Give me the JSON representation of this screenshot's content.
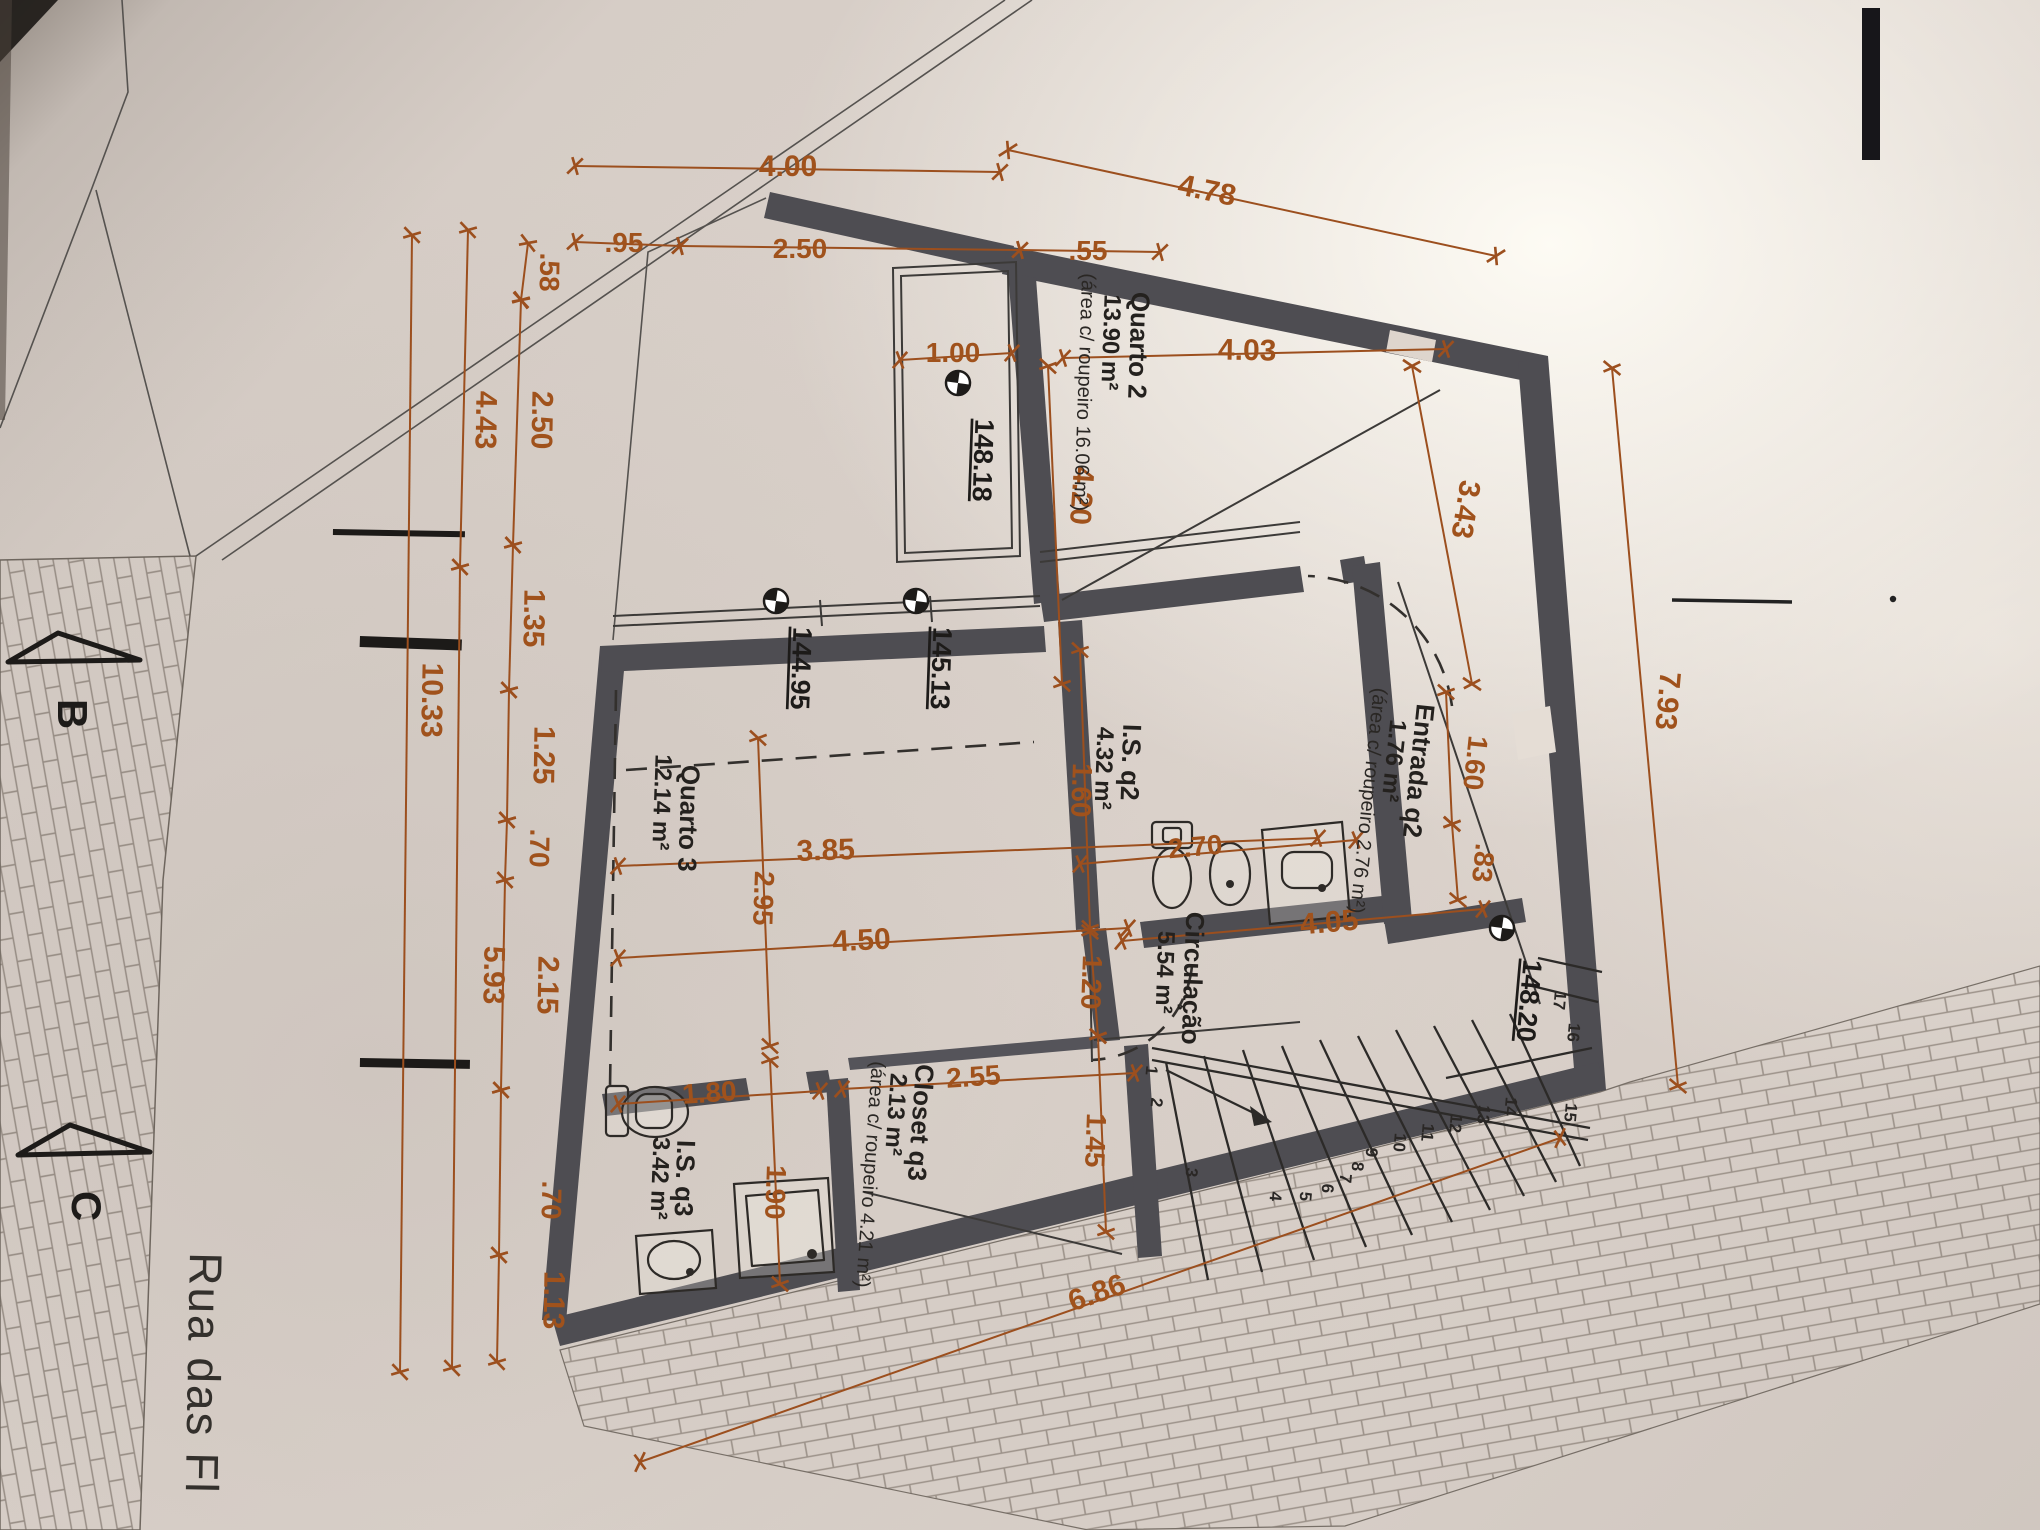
{
  "document": {
    "type": "architectural-floor-plan-photo",
    "language": "pt",
    "street": {
      "name": "Rua das Fl"
    },
    "sections": {
      "b": "B",
      "c": "C"
    }
  },
  "colors": {
    "paper": "#d8cfc8",
    "wall": "#4e4d52",
    "dimension": "#9c4f1e",
    "ink": "#262422"
  },
  "rooms": {
    "q2": {
      "name": "Quarto 2",
      "area": "13.90 m²",
      "note": "(área c/ roupeiro 16.06 m²)"
    },
    "isq2": {
      "name": "I.S. q2",
      "area": "4.32 m²"
    },
    "entrada": {
      "name": "Entrada q2",
      "area": "1.76 m²",
      "note": "(área c/ roupeiro 2.76 m²)"
    },
    "circulacao": {
      "name": "Circulação",
      "area": "5.54 m²"
    },
    "q3": {
      "name": "Quarto 3",
      "area": "12.14 m²"
    },
    "isq3": {
      "name": "I.S. q3",
      "area": "3.42 m²"
    },
    "closet": {
      "name": "Closet q3",
      "area": "2.13 m²",
      "note": "(área c/ roupeiro 4.21 m²)"
    }
  },
  "levels": {
    "l1": "148.18",
    "l2": "144.95",
    "l3": "145.13",
    "l4": "148.20"
  },
  "dims": {
    "d400": "4.00",
    "d95": ".95",
    "d250": "2.50",
    "d55": ".55",
    "d478": "4.78",
    "d100": "1.00",
    "d403": "4.03",
    "d385": "3.85",
    "d450": "4.50",
    "d405": "4.05",
    "d180": "1.80",
    "d255": "2.55",
    "d270": "2.70",
    "d686": "6.86",
    "v58": ".58",
    "v250": "2.50",
    "v135": "1.35",
    "v125": "1.25",
    "v70a": ".70",
    "v215": "2.15",
    "v70b": ".70",
    "v113": "1.13",
    "v443": "4.43",
    "v593": "5.93",
    "v1033": "10.33",
    "v420": "4.20",
    "v343": "3.43",
    "v160a": "1.60",
    "v120": "1.20",
    "v145": "1.45",
    "v160b": "1.60",
    "v83": ".83",
    "v793": "7.93",
    "v295": "2.95",
    "v190": "1.90"
  },
  "stairs": {
    "numbers": [
      "1",
      "2",
      "3",
      "4",
      "5",
      "6",
      "7",
      "8",
      "9",
      "10",
      "11",
      "12",
      "13",
      "14",
      "15",
      "16",
      "17"
    ]
  }
}
